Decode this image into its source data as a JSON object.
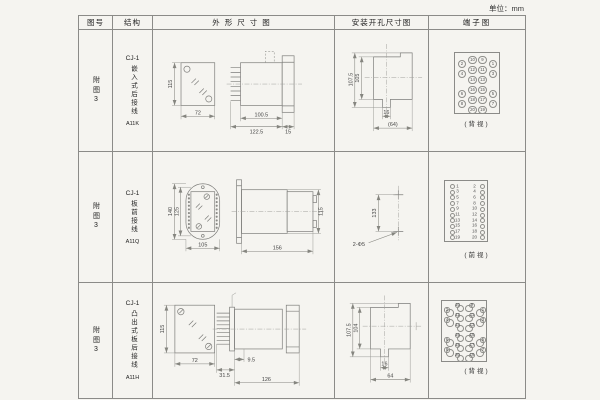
{
  "unit_label": "单位：mm",
  "headers": {
    "fig_no": "图号",
    "structure": "结构",
    "outline": "外形尺寸图",
    "install": "安装开孔尺寸图",
    "terminal": "端子图"
  },
  "rows": [
    {
      "fig_no": "附图3",
      "structure": {
        "model": "CJ-1",
        "desc": "嵌入式后接线",
        "code": "A11K"
      },
      "outline": {
        "front_height": "115",
        "front_width": "72",
        "body_depth": "100.5",
        "total_depth": "122.5",
        "flange_depth": "15"
      },
      "install": {
        "height_outer": "107.5",
        "height_inner": "105",
        "slot_width": "16",
        "width_total": "(64)"
      },
      "terminal": {
        "view": "(背视)"
      }
    },
    {
      "fig_no": "附图3",
      "structure": {
        "model": "CJ-1",
        "desc": "板前接线",
        "code": "A11Q"
      },
      "outline": {
        "height_outer": "140",
        "height_inner": "125",
        "front_width": "105",
        "total_depth": "156",
        "side_height": "115"
      },
      "install": {
        "hole_spacing": "133",
        "hole_label": "2-Φ5"
      },
      "terminal": {
        "view": "(前视)"
      }
    },
    {
      "fig_no": "附图3",
      "structure": {
        "model": "CJ-1",
        "desc": "凸出式板后接线",
        "code": "A11H"
      },
      "outline": {
        "front_height": "115",
        "front_width": "72",
        "pin_depth": "31.5",
        "plate_depth": "9.5",
        "total_depth": "126"
      },
      "install": {
        "height_outer": "107.5",
        "height_inner": "104",
        "slot_width": "16",
        "width_total": "64"
      },
      "terminal": {
        "view": "(背视)"
      }
    }
  ],
  "terminal_layouts": {
    "t1": {
      "style": "num",
      "pins": [
        {
          "n": "10",
          "x": 17.5,
          "y": 7
        },
        {
          "n": "9",
          "x": 27.5,
          "y": 7
        },
        {
          "n": "2",
          "x": 7,
          "y": 11
        },
        {
          "n": "1",
          "x": 38,
          "y": 11
        },
        {
          "n": "12",
          "x": 17.5,
          "y": 17
        },
        {
          "n": "11",
          "x": 27.5,
          "y": 17
        },
        {
          "n": "4",
          "x": 7,
          "y": 21
        },
        {
          "n": "3",
          "x": 38,
          "y": 21
        },
        {
          "n": "14",
          "x": 17.5,
          "y": 27
        },
        {
          "n": "13",
          "x": 27.5,
          "y": 27
        },
        {
          "n": "16",
          "x": 17.5,
          "y": 37
        },
        {
          "n": "15",
          "x": 27.5,
          "y": 37
        },
        {
          "n": "6",
          "x": 7,
          "y": 41
        },
        {
          "n": "5",
          "x": 38,
          "y": 41
        },
        {
          "n": "18",
          "x": 17.5,
          "y": 47
        },
        {
          "n": "17",
          "x": 27.5,
          "y": 47
        },
        {
          "n": "8",
          "x": 7,
          "y": 51
        },
        {
          "n": "7",
          "x": 38,
          "y": 51
        },
        {
          "n": "20",
          "x": 17.5,
          "y": 57
        },
        {
          "n": "19",
          "x": 27.5,
          "y": 57
        }
      ]
    },
    "t2": {
      "style": "side",
      "pins": [
        {
          "n": "1",
          "cx": 7,
          "cy": 5.5,
          "nx": 12.5
        },
        {
          "n": "2",
          "cx": 37,
          "cy": 5.5,
          "nx": 29.5
        },
        {
          "n": "3",
          "cx": 7,
          "cy": 11.2,
          "nx": 12.5
        },
        {
          "n": "4",
          "cx": 37,
          "cy": 11.2,
          "nx": 29.5
        },
        {
          "n": "5",
          "cx": 7,
          "cy": 16.9,
          "nx": 12.5
        },
        {
          "n": "6",
          "cx": 37,
          "cy": 16.9,
          "nx": 29.5
        },
        {
          "n": "7",
          "cx": 7,
          "cy": 22.6,
          "nx": 12.5
        },
        {
          "n": "8",
          "cx": 37,
          "cy": 22.6,
          "nx": 29.5
        },
        {
          "n": "9",
          "cx": 7,
          "cy": 28.3,
          "nx": 12.5
        },
        {
          "n": "10",
          "cx": 37,
          "cy": 28.3,
          "nx": 29.5
        },
        {
          "n": "11",
          "cx": 7,
          "cy": 34,
          "nx": 12.5
        },
        {
          "n": "12",
          "cx": 37,
          "cy": 34,
          "nx": 29.5
        },
        {
          "n": "13",
          "cx": 7,
          "cy": 39.7,
          "nx": 12.5
        },
        {
          "n": "14",
          "cx": 37,
          "cy": 39.7,
          "nx": 29.5
        },
        {
          "n": "15",
          "cx": 7,
          "cy": 45.4,
          "nx": 12.5
        },
        {
          "n": "16",
          "cx": 37,
          "cy": 45.4,
          "nx": 29.5
        },
        {
          "n": "17",
          "cx": 7,
          "cy": 51.1,
          "nx": 12.5
        },
        {
          "n": "18",
          "cx": 37,
          "cy": 51.1,
          "nx": 29.5
        },
        {
          "n": "19",
          "cx": 7,
          "cy": 56.8,
          "nx": 12.5
        },
        {
          "n": "20",
          "cx": 37,
          "cy": 56.8,
          "nx": 29.5
        }
      ]
    },
    "t3": {
      "style": "bubble",
      "pins": [
        {
          "n": "10",
          "x": 18.5,
          "y": 7.5,
          "bx": 15.5,
          "by": 4.5
        },
        {
          "n": "9",
          "x": 27,
          "y": 7.5,
          "bx": 30,
          "by": 4.5
        },
        {
          "n": "2",
          "x": 8,
          "y": 12,
          "bx": 5,
          "by": 9
        },
        {
          "n": "1",
          "x": 38,
          "y": 12,
          "bx": 41,
          "by": 9
        },
        {
          "n": "12",
          "x": 18.5,
          "y": 17.5,
          "bx": 15.5,
          "by": 14.5
        },
        {
          "n": "11",
          "x": 27,
          "y": 17.5,
          "bx": 30,
          "by": 14.5
        },
        {
          "n": "4",
          "x": 8,
          "y": 22,
          "bx": 5,
          "by": 19
        },
        {
          "n": "3",
          "x": 38,
          "y": 22,
          "bx": 41,
          "by": 19
        },
        {
          "n": "14",
          "x": 18.5,
          "y": 27.5,
          "bx": 15.5,
          "by": 24.5
        },
        {
          "n": "13",
          "x": 27,
          "y": 27.5,
          "bx": 30,
          "by": 24.5
        },
        {
          "n": "16",
          "x": 18.5,
          "y": 37.5,
          "bx": 15.5,
          "by": 34.5
        },
        {
          "n": "15",
          "x": 27,
          "y": 37.5,
          "bx": 30,
          "by": 34.5
        },
        {
          "n": "6",
          "x": 8,
          "y": 42,
          "bx": 5,
          "by": 39
        },
        {
          "n": "5",
          "x": 38,
          "y": 42,
          "bx": 41,
          "by": 39
        },
        {
          "n": "18",
          "x": 18.5,
          "y": 47.5,
          "bx": 15.5,
          "by": 44.5
        },
        {
          "n": "17",
          "x": 27,
          "y": 47.5,
          "bx": 30,
          "by": 44.5
        },
        {
          "n": "8",
          "x": 8,
          "y": 52,
          "bx": 5,
          "by": 49
        },
        {
          "n": "7",
          "x": 38,
          "y": 52,
          "bx": 41,
          "by": 49
        },
        {
          "n": "20",
          "x": 18.5,
          "y": 57.5,
          "bx": 15.5,
          "by": 54.5
        },
        {
          "n": "19",
          "x": 27,
          "y": 57.5,
          "bx": 30,
          "by": 54.5
        }
      ]
    }
  }
}
